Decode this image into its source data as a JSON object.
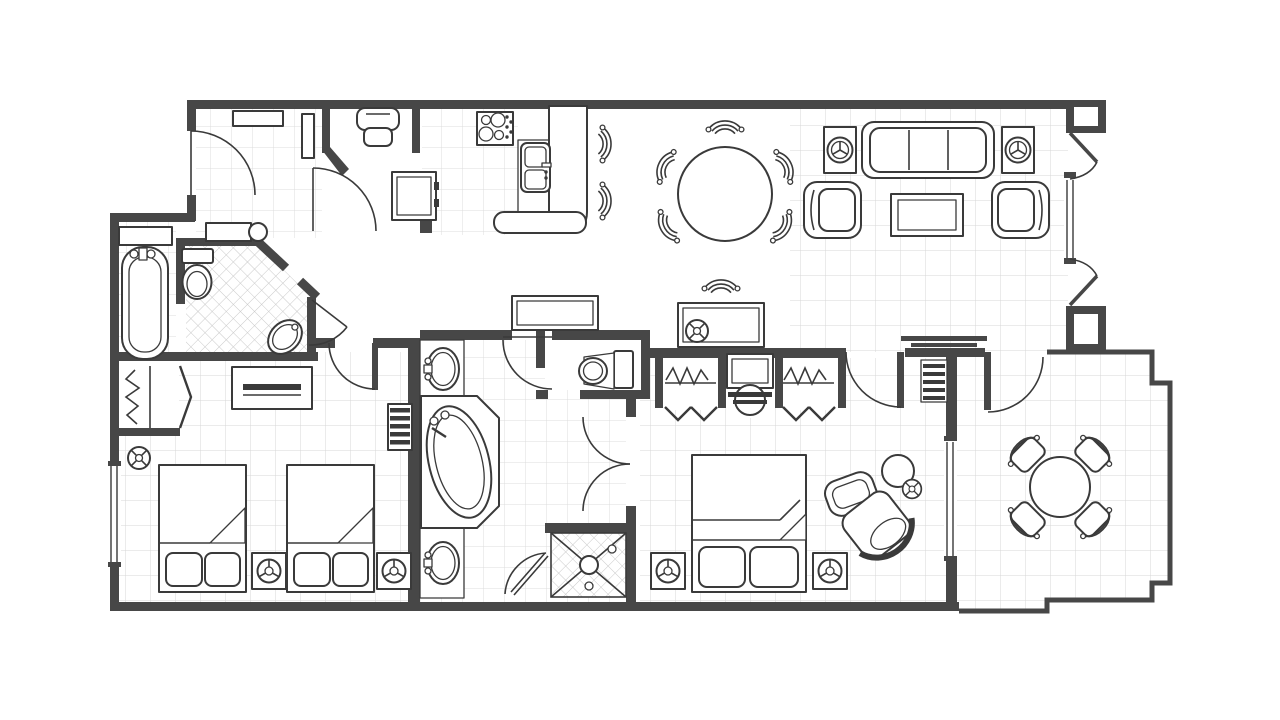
{
  "meta": {
    "type": "architectural floor plan",
    "description": "Two-bedroom, two-and-a-half-bath suite floor plan with entry hall, kitchen, dining area, living room with fireplace, guest bedroom, master suite and balcony",
    "canvas": {
      "width": 1280,
      "height": 720
    }
  },
  "palette": {
    "background": "#ffffff",
    "walls": "#474747",
    "furniture_outline": "#3a3a3a",
    "grid_fine": "#dcdcdc",
    "grid_coarse": "#d7d7d7",
    "tile_hatch": "#c9c9c9"
  },
  "rooms": [
    {
      "name": "Entry Hall",
      "furniture": [
        "entry door",
        "wall shelf",
        "mirror",
        "luggage bench"
      ]
    },
    {
      "name": "Laundry Closet",
      "furniture": [
        "washer"
      ]
    },
    {
      "name": "Guest Bathroom",
      "furniture": [
        "bathtub",
        "shelf",
        "toilet",
        "corner vanity sink",
        "tiled floor",
        "door"
      ]
    },
    {
      "name": "Kitchen",
      "furniture": [
        "4-burner cooktop",
        "double sink",
        "breakfast-bar counter",
        "refrigerator",
        "2 bar stools",
        "tiled floor"
      ]
    },
    {
      "name": "Dining Area",
      "furniture": [
        "round dining table",
        "5 dining chairs",
        "writing desk with chair",
        "console table"
      ]
    },
    {
      "name": "Living Room",
      "furniture": [
        "3-seat sofa",
        "2 armchairs",
        "coffee table",
        "2 media stands",
        "fireplace",
        "french doors to balcony",
        "2 structural columns"
      ]
    },
    {
      "name": "Guest Bedroom",
      "furniture": [
        "2 double beds",
        "2 nightstands",
        "dresser",
        "closet with bi-fold doors",
        "ceiling fan",
        "luggage rack",
        "window"
      ]
    },
    {
      "name": "Master Bathroom",
      "furniture": [
        "double vanity with 2 sinks",
        "garden tub",
        "walk-in shower",
        "shower door",
        "double entry doors"
      ]
    },
    {
      "name": "Water Closet",
      "furniture": [
        "toilet"
      ]
    },
    {
      "name": "Master Bedroom",
      "furniture": [
        "king bed",
        "2 nightstands",
        "2 closets with bi-fold doors",
        "dressing vanity with stool",
        "barrel chair",
        "ottoman",
        "round side table",
        "window",
        "door to balcony"
      ]
    },
    {
      "name": "Balcony",
      "furniture": [
        "round patio table",
        "4 patio chairs"
      ]
    },
    {
      "name": "Hallway",
      "furniture": [
        "console table",
        "bathroom door"
      ]
    }
  ]
}
